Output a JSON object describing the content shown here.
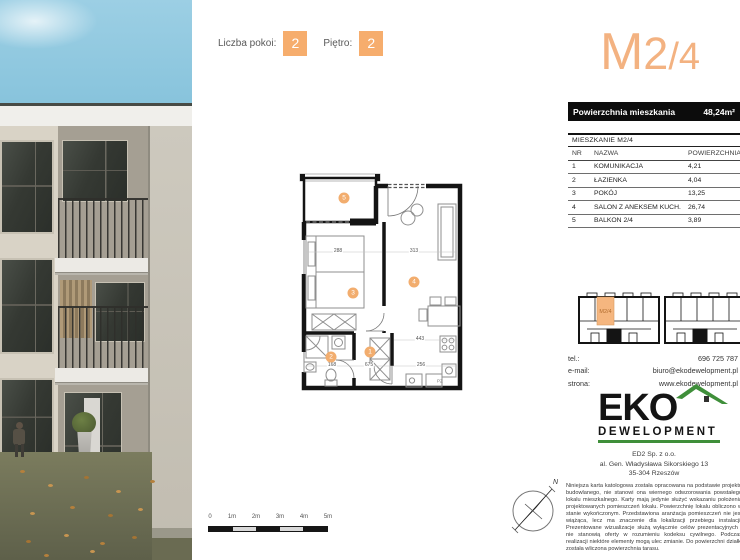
{
  "top": {
    "rooms_label": "Liczba pokoi:",
    "rooms_value": "2",
    "floor_label": "Piętro:",
    "floor_value": "2"
  },
  "title": {
    "part1": "M",
    "part2": "2",
    "part3": "/4"
  },
  "area_bar": {
    "label": "Powierzchnia mieszkania",
    "value": "48,24m²"
  },
  "table": {
    "title": "MIESZKANIE M2/4",
    "headers": {
      "nr": "NR",
      "name": "NAZWA",
      "area": "POWIERZCHNIA"
    },
    "rows": [
      {
        "nr": "1",
        "name": "KOMUNIKACJA",
        "area": "4,21"
      },
      {
        "nr": "2",
        "name": "ŁAZIENKA",
        "area": "4,04"
      },
      {
        "nr": "3",
        "name": "POKÓJ",
        "area": "13,25"
      },
      {
        "nr": "4",
        "name": "SALON Z ANEKSEM KUCH.",
        "area": "26,74"
      },
      {
        "nr": "5",
        "name": "BALKON 2/4",
        "area": "3,89"
      }
    ]
  },
  "plan": {
    "markers": [
      "1",
      "2",
      "3",
      "4",
      "5"
    ],
    "dimensions": [
      "288",
      "313",
      "443",
      "168",
      "675",
      "256"
    ],
    "appliance_label": "PZ"
  },
  "mini_plan": {
    "unit_label": "M2/4"
  },
  "contact": {
    "rows": [
      {
        "label": "tel.:",
        "value": "696 725 787"
      },
      {
        "label": "e-mail:",
        "value": "biuro@ekodewelopment.pl"
      },
      {
        "label": "strona:",
        "value": "www.ekodewelopment.pl"
      }
    ]
  },
  "logo": {
    "brand": "EKO",
    "sub": "DEWELOPMENT"
  },
  "address": {
    "line1": "ED2 Sp. z o.o.",
    "line2": "al. Gen. Władysława Sikorskiego 13",
    "line3": "35-304 Rzeszów"
  },
  "disclaimer": "Niniejsza karta katologowa została opracowana na podstawie projektu budowlanego, nie stanowi ona wiernego odwzorowania powstałego lokalu mieszkalnego. Karty mają jedynie służyć wskazaniu położenia projektowanych pomieszczeń lokalu. Powierzchnię lokalu obliczono w stanie wykończonym. Przedstawiona aranżacja pomieszczeń nie jest wiążąca, lecz ma znaczenie dla lokalizacji przebiegu instalacji. Prezentowane wizualizacje służą wyłącznie celów prezentacyjnych i nie stanowią oferty w rozumieniu kodeksu cywilnego. Podczas realizacji niektóre elementy mogą ulec zmianie. Do powierzchni działki została wliczona powierzchnia tarasu.",
  "scale": {
    "labels": [
      "0",
      "1m",
      "2m",
      "3m",
      "4m",
      "5m"
    ]
  },
  "compass": {
    "north_label": "N"
  },
  "colors": {
    "accent_orange": "#f6ad6d",
    "title_orange": "#f3b281",
    "logo_green": "#3f8f3a",
    "bar_black": "#0c0c0c"
  }
}
